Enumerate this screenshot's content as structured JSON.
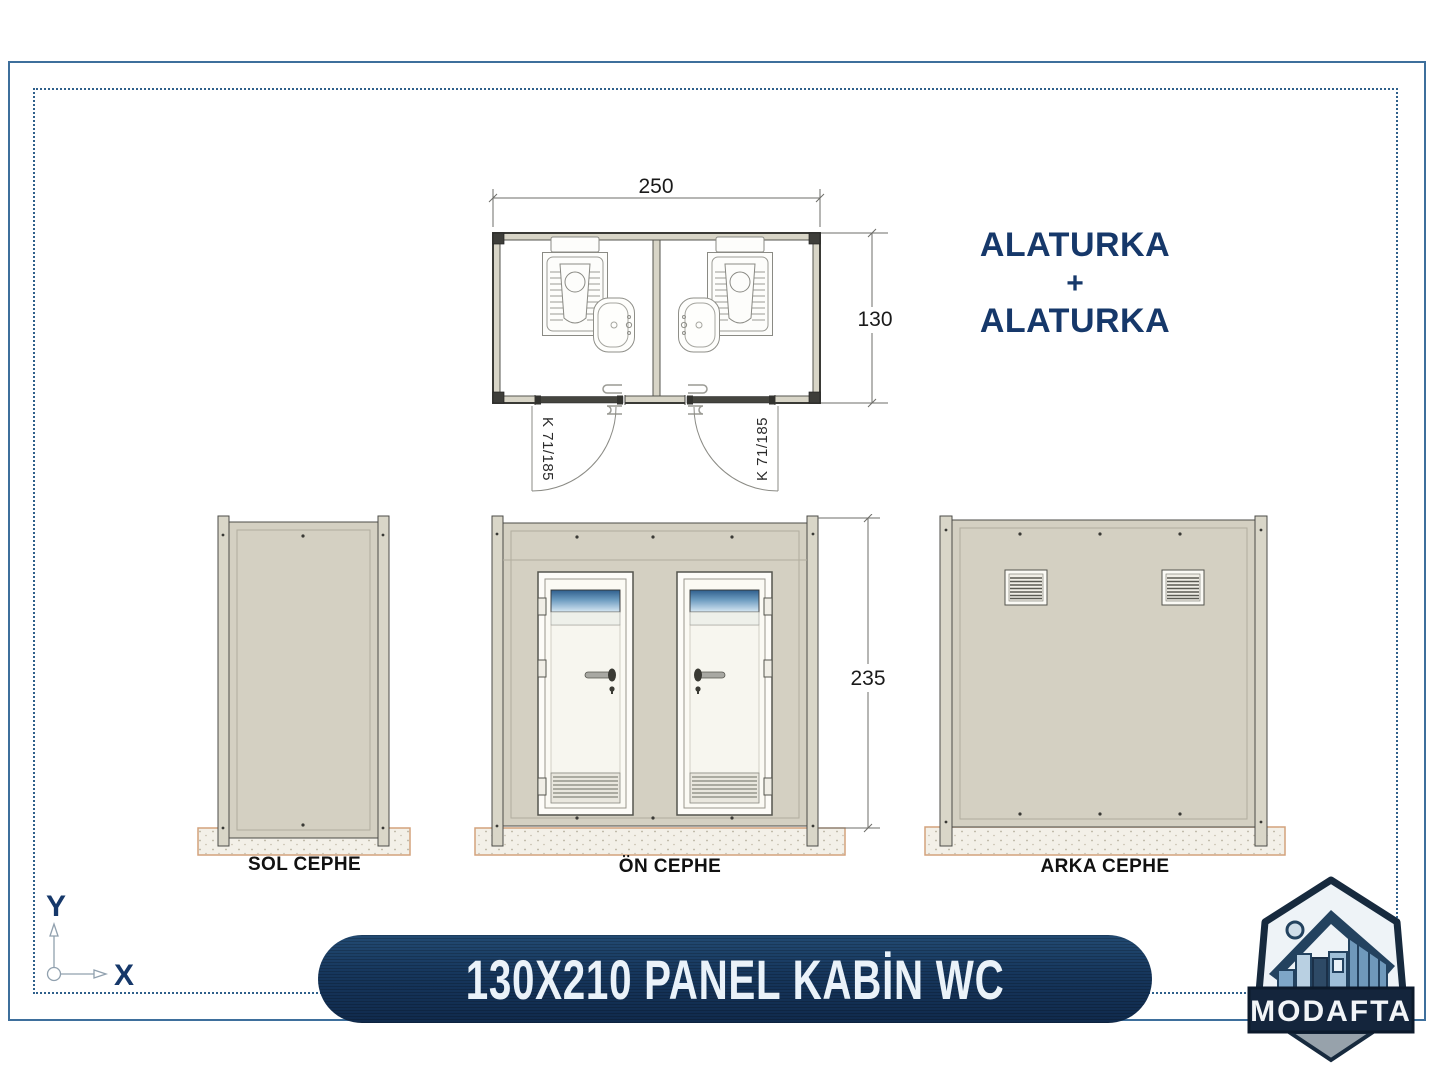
{
  "colors": {
    "accent": "#16386a",
    "banner-bg": "#16395f",
    "banner-text": "#eaf2f9",
    "border-solid": "#3e6f9c",
    "border-dotted": "#2f608b",
    "panel-beige": "#d4d0c2",
    "drawing-line": "#4b4b46",
    "base-outline": "#d3a27c",
    "window-blue": "#33658f"
  },
  "plan": {
    "width_label": "250",
    "depth_label": "130",
    "door_left_label": "K 71/185",
    "door_right_label": "K 71/185"
  },
  "note": {
    "line1": "ALATURKA",
    "plus": "+",
    "line2": "ALATURKA"
  },
  "elevations": {
    "height_label": "235",
    "left": "SOL CEPHE",
    "front": "ÖN CEPHE",
    "back": "ARKA CEPHE"
  },
  "axis": {
    "x": "X",
    "y": "Y"
  },
  "banner": {
    "title": "130X210 PANEL KABİN WC"
  },
  "logo": {
    "brand": "MODAFTA"
  }
}
